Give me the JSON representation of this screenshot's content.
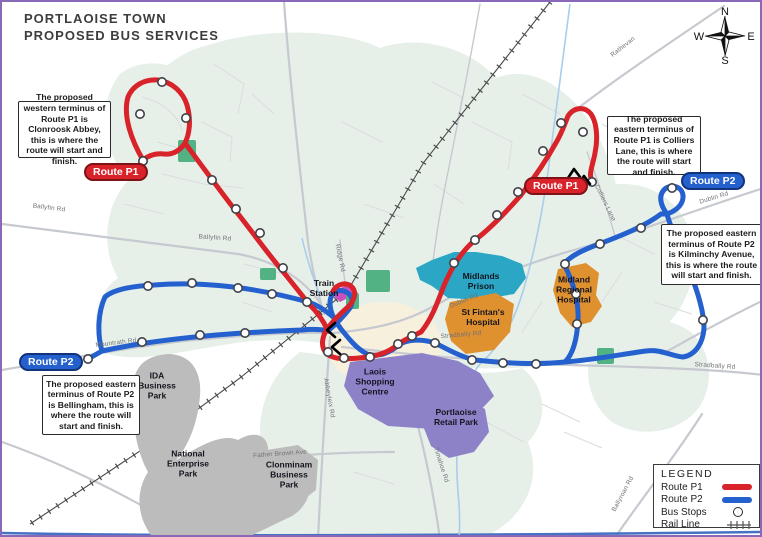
{
  "title": {
    "line1": "PORTLAOISE TOWN",
    "line2": "PROPOSED BUS SERVICES"
  },
  "compass": {
    "n": "N",
    "e": "E",
    "s": "S",
    "w": "W"
  },
  "routes": {
    "p1": {
      "label": "Route P1",
      "color": "#d8232a"
    },
    "p2": {
      "label": "Route P2",
      "color": "#2560cf"
    }
  },
  "callouts": [
    {
      "text": "The proposed western terminus of Route P1 is Clonroosk Abbey, this is where the route will start and finish."
    },
    {
      "text": "The proposed eastern terminus of Route P1 is Colliers Lane, this is where the route will start and finish."
    },
    {
      "text": "The proposed eastern terminus of Route P2 is Kilminchy Avenue, this is where the route will start and finish."
    },
    {
      "text": "The proposed eastern terminus of Route P2 is Bellingham, this is where the route will start and finish."
    }
  ],
  "areas": [
    {
      "label": "IDA\nBusiness\nPark",
      "color": "#bcbcbc"
    },
    {
      "label": "National\nEnterprise\nPark",
      "color": "#bcbcbc"
    },
    {
      "label": "Clonminam\nBusiness\nPark",
      "color": "#bcbcbc"
    },
    {
      "label": "Laois\nShopping\nCentre",
      "color": "#8d82c8"
    },
    {
      "label": "Portlaoise\nRetail Park",
      "color": "#8d82c8"
    },
    {
      "label": "Midlands\nPrison",
      "color": "#2ba7c5"
    },
    {
      "label": "St Fintan's\nHospital",
      "color": "#e0912f"
    },
    {
      "label": "Midland\nRegional\nHospital",
      "color": "#e0912f"
    },
    {
      "label": "Train\nStation",
      "color": "#c84fc0"
    }
  ],
  "roads": [
    "Ballyfin Rd",
    "Ballyfin Rd",
    "Mountrath Rd",
    "Dublin Rd",
    "Dublin Rd",
    "Stradbally Rd",
    "Stradbally Rd",
    "Timahoe Rd",
    "Abbeyleix Rd",
    "Father Brown Ave",
    "Ballyroan Rd",
    "Rathevan",
    "Colliers Lane",
    "Ridge Rd"
  ],
  "legend": {
    "title": "LEGEND",
    "items": [
      {
        "label": "Route P1",
        "symbol": "line",
        "color": "#d8232a"
      },
      {
        "label": "Route P2",
        "symbol": "line",
        "color": "#2560cf"
      },
      {
        "label": "Bus Stops",
        "symbol": "circle"
      },
      {
        "label": "Rail Line",
        "symbol": "rail"
      }
    ]
  }
}
